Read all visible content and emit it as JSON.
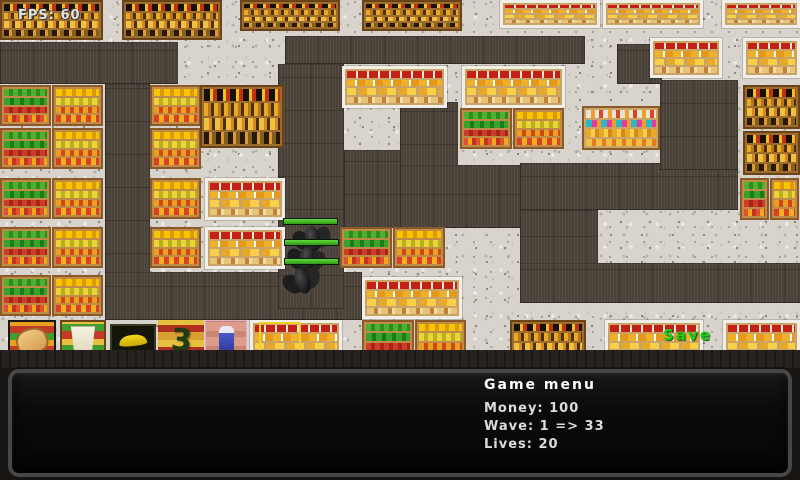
{
  "hud": {
    "fps": "FPS: 60",
    "save_floater": "Save"
  },
  "menu": {
    "title": "Game menu",
    "money": "Money: 100",
    "wave": "Wave: 1 => 33",
    "lives": "Lives: 20"
  },
  "colors": {
    "path": "#4e453c",
    "floor": "#d8d4cd",
    "health_green": "#49c41c",
    "save_green": "#1ecc1e",
    "selection_yellow": "#f0d020"
  },
  "map": {
    "path_rects": [
      [
        0,
        42,
        178,
        42
      ],
      [
        105,
        84,
        45,
        236
      ],
      [
        105,
        272,
        257,
        48
      ],
      [
        285,
        36,
        300,
        28
      ],
      [
        278,
        64,
        66,
        245
      ],
      [
        344,
        150,
        106,
        78
      ],
      [
        400,
        102,
        58,
        76
      ],
      [
        400,
        165,
        125,
        63
      ],
      [
        520,
        163,
        218,
        47
      ],
      [
        660,
        80,
        78,
        90
      ],
      [
        617,
        44,
        45,
        40
      ],
      [
        520,
        210,
        78,
        93
      ],
      [
        520,
        263,
        280,
        40
      ]
    ],
    "shelves": [
      [
        "bottles",
        0,
        0,
        103,
        40
      ],
      [
        "bottles",
        122,
        0,
        100,
        40
      ],
      [
        "bottles",
        240,
        0,
        100,
        31
      ],
      [
        "bottles",
        362,
        0,
        100,
        31
      ],
      [
        "cheese",
        500,
        0,
        100,
        28
      ],
      [
        "cheese",
        603,
        0,
        100,
        28
      ],
      [
        "cheese",
        722,
        0,
        78,
        28
      ],
      [
        "produceGR",
        0,
        85,
        51,
        41
      ],
      [
        "produceY",
        52,
        85,
        51,
        41
      ],
      [
        "produceGR",
        0,
        128,
        51,
        41
      ],
      [
        "produceY",
        52,
        128,
        51,
        41
      ],
      [
        "produceGR",
        0,
        178,
        51,
        41
      ],
      [
        "produceY",
        52,
        178,
        51,
        41
      ],
      [
        "produceGR",
        0,
        227,
        51,
        41
      ],
      [
        "produceY",
        52,
        227,
        51,
        41
      ],
      [
        "produceGR",
        0,
        275,
        51,
        41
      ],
      [
        "produceY",
        52,
        275,
        51,
        41
      ],
      [
        "produceY",
        150,
        85,
        51,
        41
      ],
      [
        "produceY",
        150,
        128,
        51,
        41
      ],
      [
        "produceY",
        150,
        178,
        51,
        41
      ],
      [
        "produceY",
        150,
        227,
        51,
        41
      ],
      [
        "bottles",
        200,
        85,
        84,
        63
      ],
      [
        "cheese",
        205,
        178,
        80,
        42
      ],
      [
        "cheese",
        205,
        227,
        80,
        42
      ],
      [
        "cheese",
        342,
        66,
        105,
        42
      ],
      [
        "cheese",
        462,
        66,
        103,
        42
      ],
      [
        "produceGR",
        460,
        108,
        52,
        41
      ],
      [
        "produceY",
        513,
        108,
        51,
        41
      ],
      [
        "cereal",
        582,
        106,
        78,
        44
      ],
      [
        "produceGR",
        340,
        227,
        52,
        41
      ],
      [
        "produceY",
        393,
        227,
        52,
        41
      ],
      [
        "cheese",
        362,
        277,
        100,
        42
      ],
      [
        "cheese",
        650,
        38,
        72,
        40
      ],
      [
        "cheese",
        743,
        38,
        57,
        40
      ],
      [
        "bottles",
        743,
        85,
        57,
        44
      ],
      [
        "bottles",
        743,
        131,
        57,
        44
      ],
      [
        "produceGR",
        740,
        178,
        29,
        42
      ],
      [
        "produceY",
        770,
        178,
        29,
        42
      ],
      [
        "cheese",
        250,
        320,
        92,
        43
      ],
      [
        "produceGR",
        362,
        320,
        52,
        43
      ],
      [
        "produceY",
        415,
        320,
        51,
        43
      ],
      [
        "bottles",
        510,
        320,
        76,
        43
      ],
      [
        "cheese",
        605,
        320,
        98,
        43
      ],
      [
        "cheese",
        723,
        320,
        77,
        43
      ]
    ],
    "toolbar": [
      {
        "kind": "bread",
        "x": 8,
        "y": 320,
        "w": 48,
        "h": 42
      },
      {
        "kind": "bucket",
        "x": 60,
        "y": 320,
        "w": 46,
        "h": 42
      },
      {
        "kind": "banana",
        "x": 110,
        "y": 324,
        "w": 46,
        "h": 34
      },
      {
        "kind": "squiggle",
        "x": 158,
        "y": 320,
        "w": 46,
        "h": 42,
        "glyph": "3"
      },
      {
        "kind": "bottle",
        "x": 205,
        "y": 320,
        "w": 42,
        "h": 42
      },
      {
        "kind": "selection",
        "x": 259,
        "y": 322,
        "w": 42,
        "h": 38
      }
    ],
    "enemies": [
      {
        "x": 295,
        "y": 226,
        "rot": -10,
        "hp_x": 283,
        "hp_y": 218
      },
      {
        "x": 289,
        "y": 247,
        "rot": 6,
        "hp_x": 284,
        "hp_y": 239
      },
      {
        "x": 285,
        "y": 268,
        "rot": -18,
        "hp_x": 284,
        "hp_y": 258
      }
    ]
  }
}
